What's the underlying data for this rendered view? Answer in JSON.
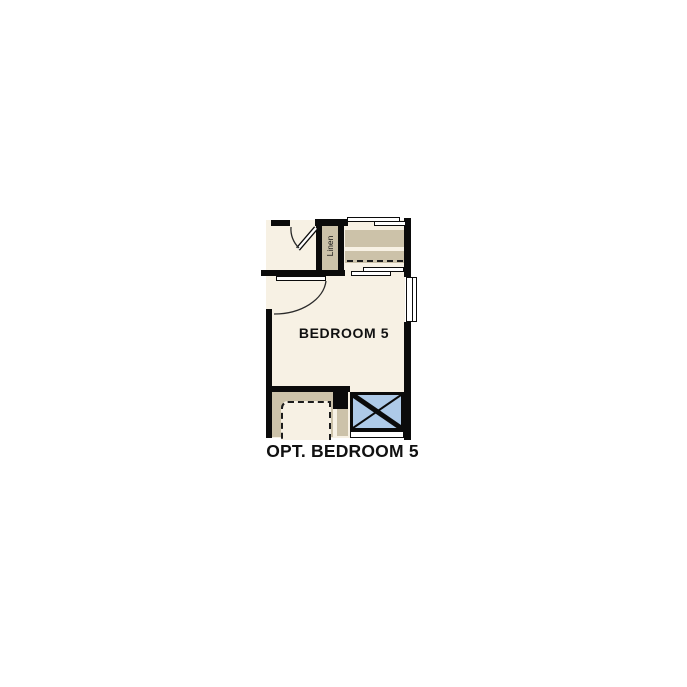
{
  "floorplan": {
    "caption": "OPT. BEDROOM 5",
    "bedroom_label": "BEDROOM 5",
    "linen_label": "Linen",
    "colors": {
      "page": "#FFFFFF",
      "floor": "#F7F1E4",
      "casework": "#CCC2A9",
      "fixture": "#AECAE8",
      "wall": "#0B0B0B",
      "text": "#111111"
    }
  }
}
